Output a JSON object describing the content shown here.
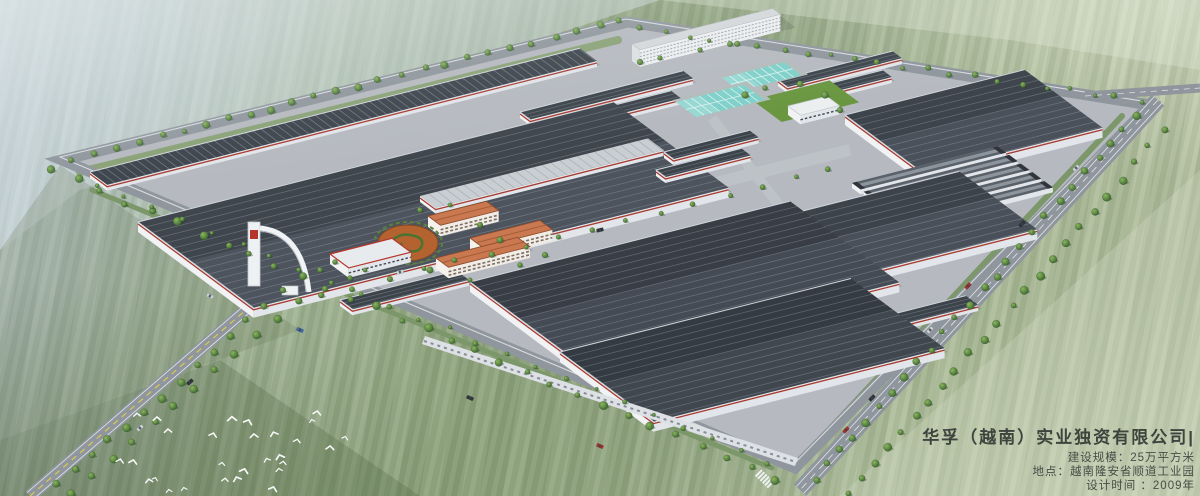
{
  "scene": {
    "type": "architectural-aerial-rendering",
    "subject": "Bird's-eye master-plan rendering of a large textile industrial park surrounded by farm fields",
    "features": [
      "dark ribbed factory roofs",
      "white dormitory slab",
      "teal wastewater treatment pools",
      "orange-roof office buildings",
      "spiral landscape garden",
      "entrance arch gate",
      "tree-lined perimeter roads",
      "flock of white birds",
      "striped farmland"
    ]
  },
  "caption": {
    "company": "华孚（越南）实业独资有限公司|",
    "lines": {
      "scale": "建设规模：25万平方米",
      "location": "地点：越南隆安省顺道工业园",
      "design_time": "设计时间 ：2009年"
    }
  },
  "palette": {
    "field_light": "#cbd6da",
    "field_green": "#8ea37c",
    "field_pale": "#b6c2a3",
    "roof_dark": "#454c55",
    "roof_darker": "#3c434b",
    "roof_light": "#c9ced3",
    "wall_white": "#f0f2f4",
    "red_stripe": "#a93a30",
    "pavement": "#b6bac0",
    "road": "#8f969d",
    "road_line": "#e3e7ea",
    "lane_yellow": "#d9ca4e",
    "tree_dark": "#37602c",
    "tree_light": "#8ab65e",
    "lawn": "#6a9640",
    "pool_teal": "#7fd0ca",
    "pool_grid": "#d9f2ee",
    "orange_roof": "#c9784f",
    "garden_orange": "#b4622f",
    "dorm_wall": "#edeff1",
    "text_color": "#3d443e",
    "bird_white": "#f7f9f8"
  }
}
